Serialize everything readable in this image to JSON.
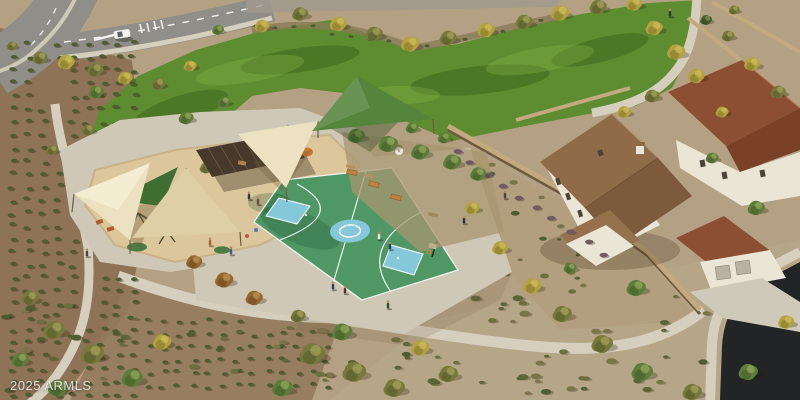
{
  "meta": {
    "type": "aerial-3d-rendering",
    "subject": "community park amenity: basketball court, shaded playground, event lawn, walking paths and adjacent homes"
  },
  "watermark": {
    "text": "2025 ARMLS"
  },
  "colors": {
    "desert": "#b4a184",
    "orchardDirt": "#8d7154",
    "orchardDirt2": "#937a5c",
    "lawn": "#5d8c31",
    "court": "#4f9765",
    "courtKey": "#85c8da",
    "courtLine": "#ffffff",
    "playSand": "#dcc79c",
    "sailCream": "#ece2c2",
    "sailCreamShade": "#decfa6",
    "sailGreen": "#55853c",
    "sailGreenDark": "#3f6e33",
    "pergola": "#46382a",
    "path": "#d6cfbe",
    "plaza": "#cfc8b6",
    "road": "#8f8e88",
    "asphalt": "#232426",
    "wall": "#c3a97e",
    "stucco": "#ebe5d5",
    "roofBrown": "#8f6b49",
    "roofBrownDark": "#7e5a3c",
    "roofRed": "#8c4f33",
    "treeYellow": "#b3a23f",
    "treeOlive": "#77793c",
    "treeGreen": "#5d7e3b",
    "treeDark": "#435f2e",
    "treeRust": "#96662f",
    "shrub": "#4e5c30",
    "shrubPurple": "#715a66",
    "watermarkColor": "#e6e6e6"
  }
}
